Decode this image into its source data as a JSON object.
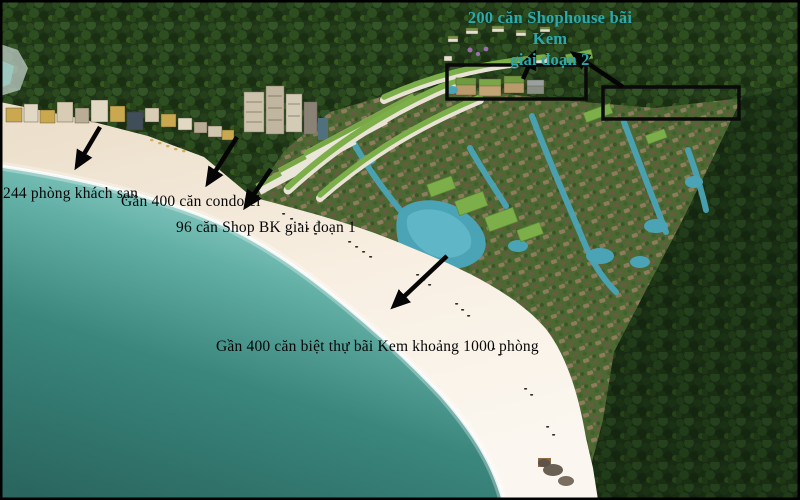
{
  "annotations": {
    "shophouse_phase2": {
      "line1": "200 căn Shophouse bãi Kem",
      "line2": "giai đoạn 2",
      "color": "#2ba9ad"
    },
    "hotel": {
      "label": "244 phòng khách sạn"
    },
    "condotel": {
      "label": "Gần 400 căn condotel"
    },
    "shop_bk_phase1": {
      "label": "96 căn Shop BK giai đoạn 1"
    },
    "villas": {
      "label": "Gần 400 căn biệt thự bãi Kem khoảng 1000 phòng"
    }
  },
  "scene": {
    "description": "aerial rendering of Bai Kem beach resort: turquoise sea, white curved beach, hotel and condotel blocks, villa field with lagoons, dark forest hills",
    "highlight_boxes": 2,
    "arrows": 6,
    "colors": {
      "sea_deep": "#2b6b64",
      "sea_shallow": "#9ad8cf",
      "sand": "#f8efe2",
      "forest": "#1f3618",
      "villa_field": "#4d6832",
      "pool_water": "#4aa4b6",
      "green_roof": "#7cae49",
      "annotation_teal": "#2ba9ad",
      "annotation_black": "#000000"
    }
  }
}
